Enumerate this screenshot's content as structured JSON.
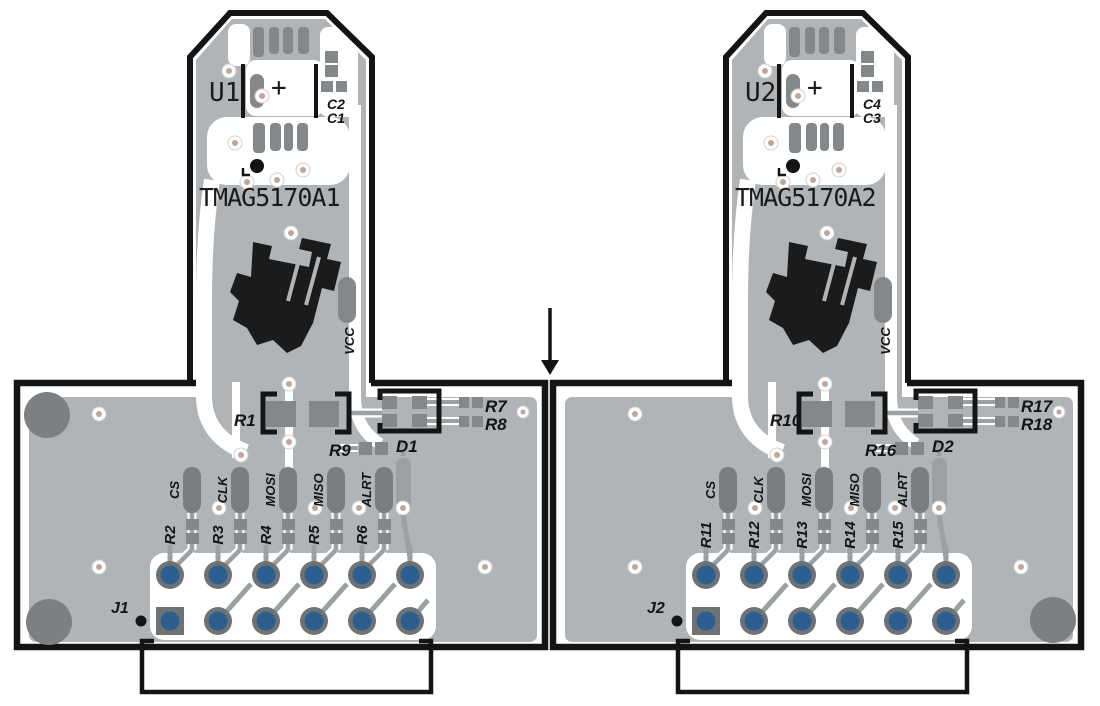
{
  "title": "TMAG5170 dual sensor PCB layout",
  "colors": {
    "board_body_gray": "#b0b4b6",
    "pad_gray": "#84888b",
    "pill_gray": "#797d80",
    "hole_ring_gray": "#6e7275",
    "hole_blue": "#2c5f90",
    "via_center_tan": "#c0a59b",
    "corner_circle_gray": "#7c8083",
    "trace_gray": "#9ba0a3",
    "outline_black": "#141414"
  },
  "boards": [
    {
      "u_label": "U1",
      "plus": "+",
      "c_top": "C2",
      "c_bottom": "C1",
      "part": "TMAG5170A1",
      "vcc": "VCC",
      "r_main": "R1",
      "r_mid": "R9",
      "diode": "D1",
      "r_a": "R7",
      "r_b": "R8",
      "signals": [
        "CS",
        "CLK",
        "MOSI",
        "MISO",
        "ALRT"
      ],
      "resistors": [
        "R2",
        "R3",
        "R4",
        "R5",
        "R6"
      ],
      "connector": "J1"
    },
    {
      "u_label": "U2",
      "plus": "+",
      "c_top": "C4",
      "c_bottom": "C3",
      "part": "TMAG5170A2",
      "vcc": "VCC",
      "r_main": "R10",
      "r_mid": "R16",
      "diode": "D2",
      "r_a": "R17",
      "r_b": "R18",
      "signals": [
        "CS",
        "CLK",
        "MOSI",
        "MISO",
        "ALRT"
      ],
      "resistors": [
        "R11",
        "R12",
        "R13",
        "R14",
        "R15"
      ],
      "connector": "J2"
    }
  ]
}
